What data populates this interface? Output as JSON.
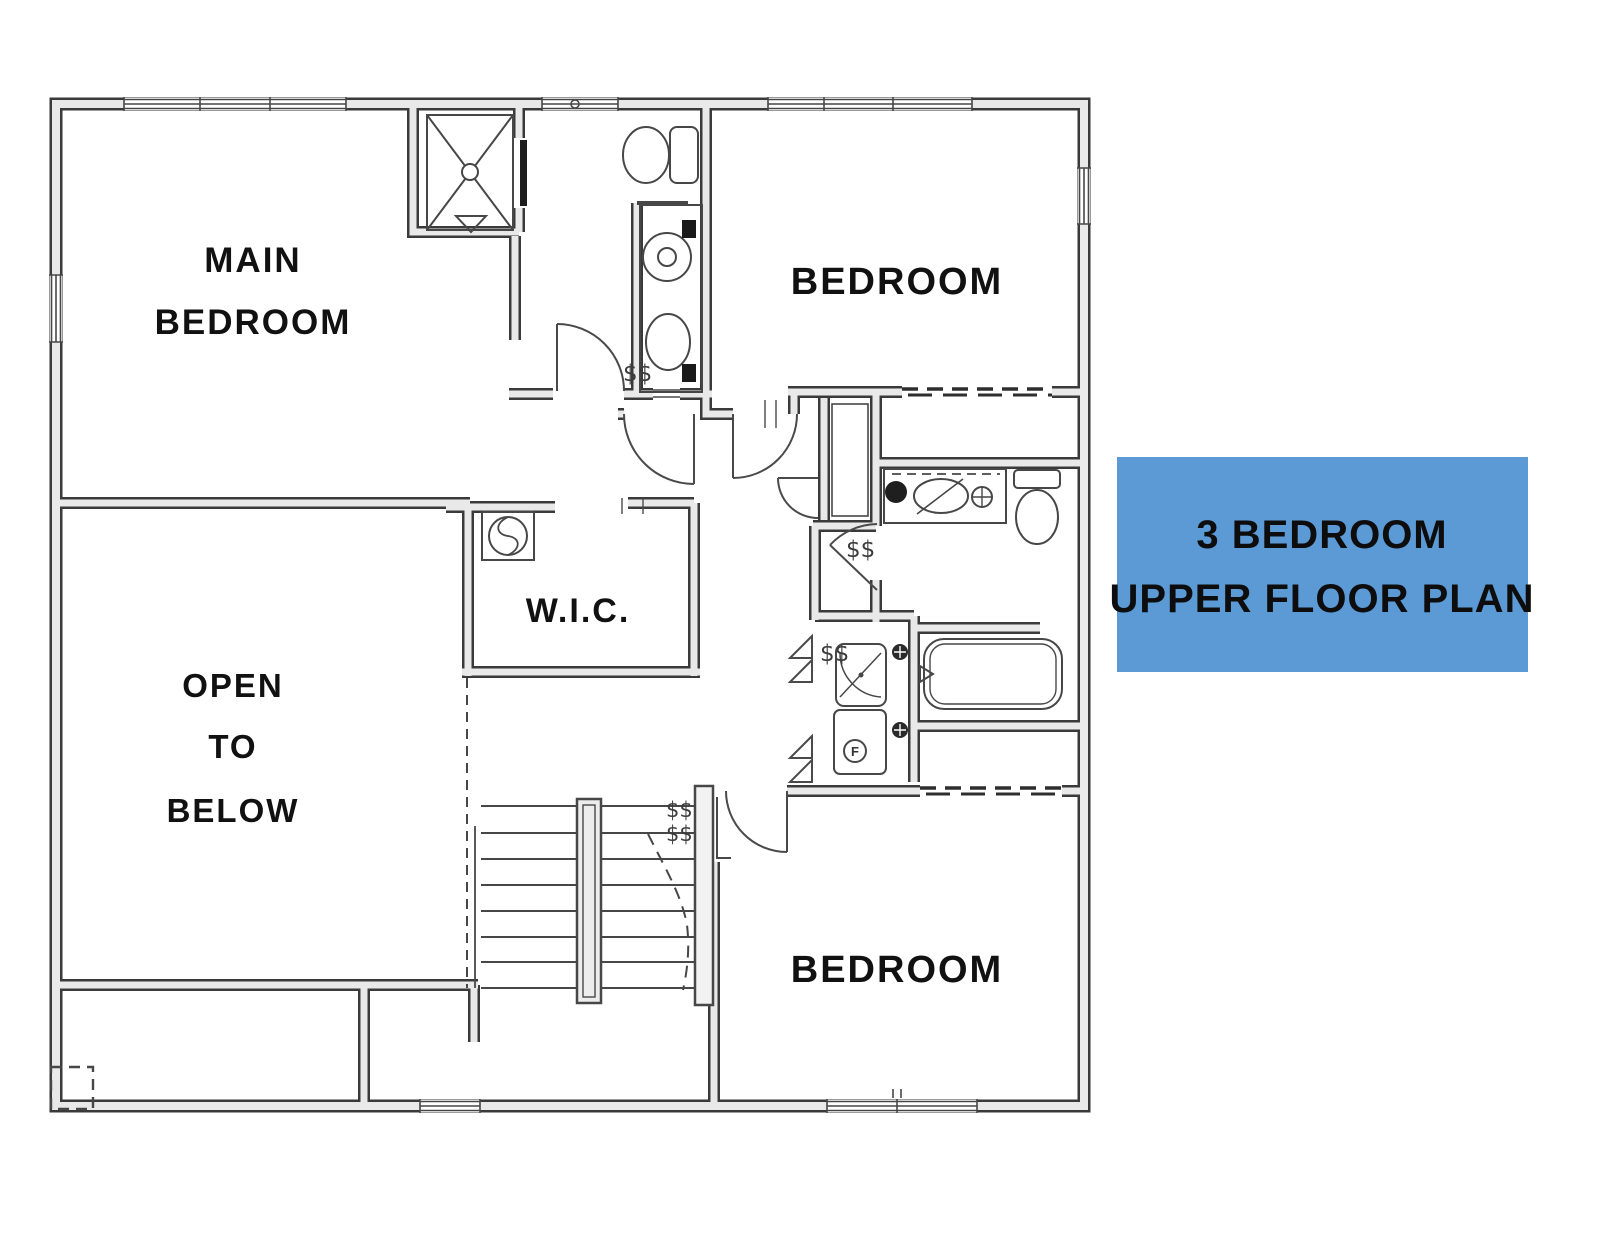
{
  "title_box": {
    "line1": "3 BEDROOM",
    "line2": "UPPER FLOOR PLAN"
  },
  "rooms": {
    "main_bedroom": {
      "line1": "MAIN",
      "line2": "BEDROOM"
    },
    "bedroom_upper_right": {
      "label": "BEDROOM"
    },
    "wic": {
      "label": "W.I.C."
    },
    "open_to_below": {
      "line1": "OPEN",
      "line2": "TO",
      "line3": "BELOW"
    },
    "bedroom_lower": {
      "label": "BEDROOM"
    }
  },
  "annotations": {
    "switch_mark": "$$",
    "dryer_letter": "F"
  },
  "colors": {
    "background": "#ffffff",
    "wall_outline": "#3a3a3a",
    "wall_fill": "#e9e9e9",
    "thin_line": "#474747",
    "title_bg": "#5b9ad5",
    "title_text": "#0d0d0d",
    "label_text": "#111111"
  }
}
